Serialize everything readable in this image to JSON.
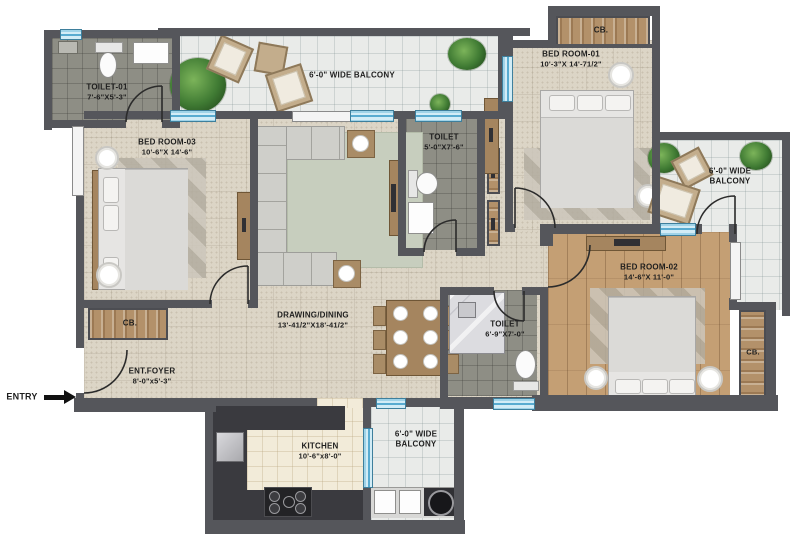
{
  "rooms": {
    "toilet_01": {
      "name": "TOILET-01",
      "dims": "7'-6\"X5'-3\""
    },
    "bed_room_03": {
      "name": "BED ROOM-03",
      "dims": "10'-6\"X 14'-6\""
    },
    "balcony_top": {
      "name": "6'-0\" WIDE BALCONY"
    },
    "bed_room_01": {
      "name": "BED ROOM-01",
      "dims": "10'-3\"X 14'-71/2\""
    },
    "toilet_mid": {
      "name": "TOILET",
      "dims": "5'-0\"X7'-6\""
    },
    "balcony_right": {
      "line1": "6'-0\" WIDE",
      "line2": "BALCONY"
    },
    "bed_room_02": {
      "name": "BED ROOM-02",
      "dims": "14'-6\"X 11'-0\""
    },
    "drawing_dining": {
      "name": "DRAWING/DINING",
      "dims": "13'-41/2\"X18'-41/2\""
    },
    "toilet_2": {
      "name": "TOILET",
      "dims": "6'-9\"X7'-0\""
    },
    "ent_foyer": {
      "name": "ENT.FOYER",
      "dims": "8'-0\"x5'-3\""
    },
    "kitchen": {
      "name": "KITCHEN",
      "dims": "10'-6\"x8'-0\""
    },
    "balcony_bottom": {
      "line1": "6'-0\" WIDE",
      "line2": "BALCONY"
    }
  },
  "closet": {
    "label": "CB."
  },
  "entry": {
    "label": "ENTRY"
  },
  "colors": {
    "wall": "#55565b",
    "floor": "#dcd5c6",
    "balcony": "#e9ebe9",
    "toilet": "#8e8e85",
    "wood": "#c49f74",
    "kitchen_floor": "#f2ebd9",
    "window": "#a9d8ec",
    "closet": "#b3916a"
  }
}
